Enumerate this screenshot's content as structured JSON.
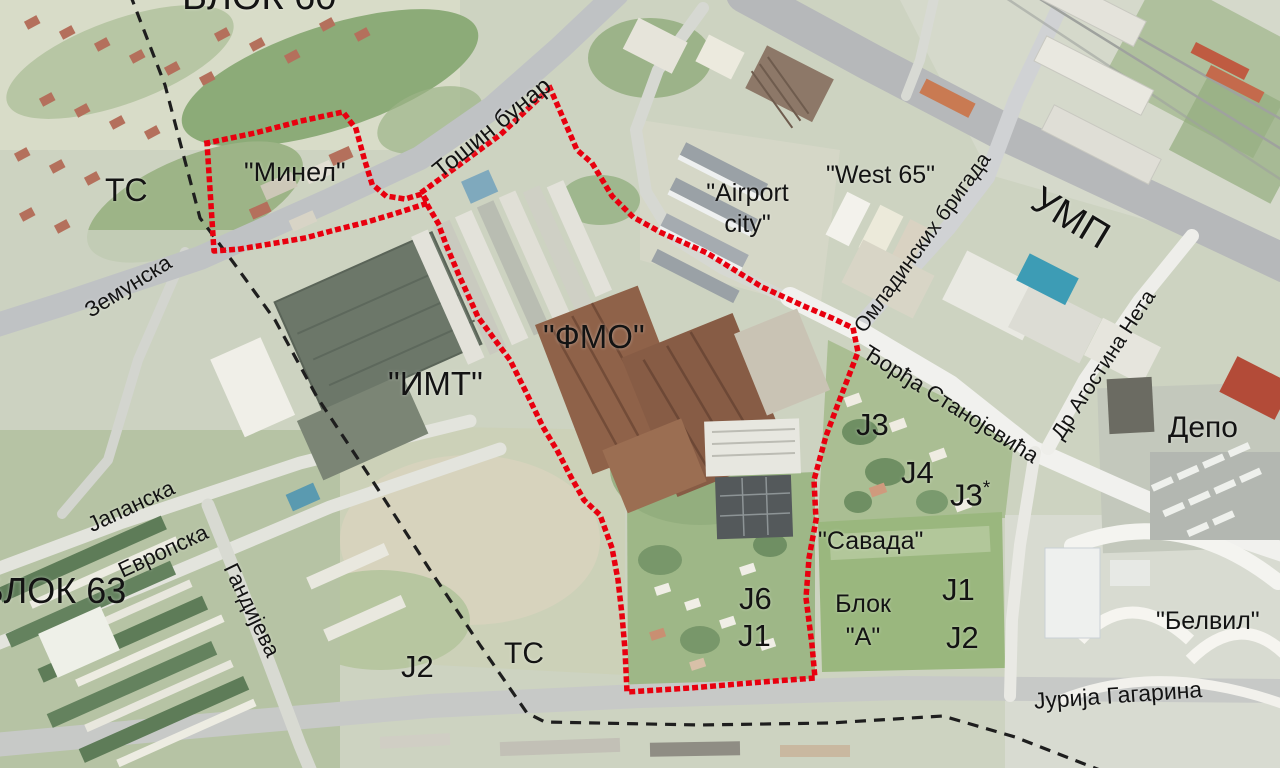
{
  "map": {
    "type": "satellite-annotation-map",
    "landmarks": {
      "blok60": "БЛОК 60",
      "ts_upper": "ТС",
      "minel": "\"Минел\"",
      "airport_city": "\"Airport city\"",
      "west65": "\"West 65\"",
      "fmo": "\"ФМО\"",
      "imt": "\"ИМТ\"",
      "depo": "Депо",
      "j3": "Ј3",
      "j4": "Ј4",
      "j3_star_base": "Ј3",
      "j3_star_sup": "*",
      "savada": "\"Савада\"",
      "blok_a_line1": "Блок",
      "blok_a_line2": "\"А\"",
      "j6": "Ј6",
      "j1_central": "Ј1",
      "j2_west": "Ј2",
      "ts_lower": "ТС",
      "j1_east": "Ј1",
      "j2_east": "Ј2",
      "belvil": "\"Белвил\"",
      "blok63": "БЛОК 63"
    },
    "streets": {
      "tosin_bunar": "Тошин бунар",
      "zemunska": "Земунска",
      "ump": "УМП",
      "omladinskih": "Омладинских бригада",
      "djordja": "Ђорђа Станојевића",
      "dr_agostina": "Др Агостина Нета",
      "jurija": "Јурија Гагарина",
      "japanska": "Јапанска",
      "evropska": "Европска",
      "gandijeva": "Гандијева"
    },
    "colors": {
      "boundary_red": "#e8000f",
      "cadastre_black": "#1e1e1e",
      "label_black": "#131313"
    }
  }
}
